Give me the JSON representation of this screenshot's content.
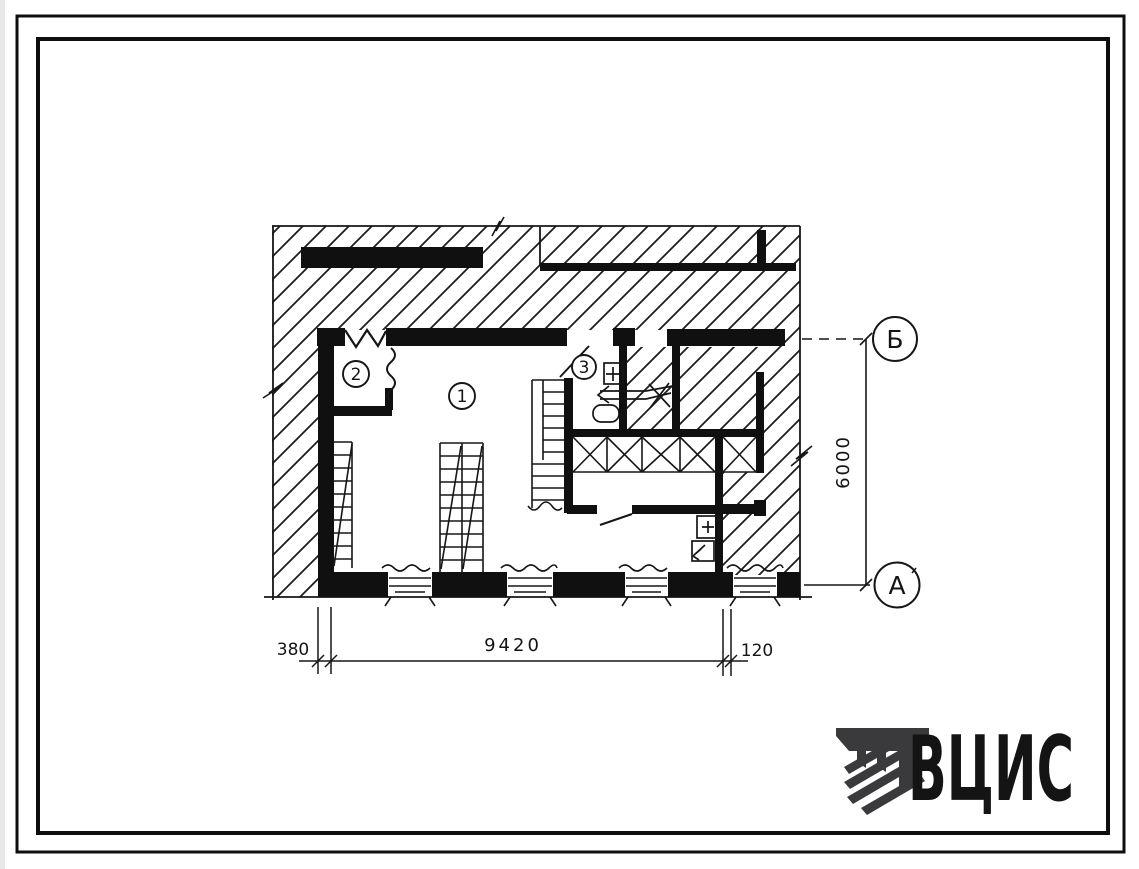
{
  "page": {
    "paper_color": "#ffffff",
    "ink_color": "#161616"
  },
  "plan": {
    "rooms": [
      {
        "number": "1"
      },
      {
        "number": "2"
      },
      {
        "number": "3"
      }
    ]
  },
  "axes": {
    "top": "Б",
    "bottom": "А"
  },
  "dimensions": {
    "bottom_left": "380",
    "bottom_span": "9420",
    "bottom_right": "120",
    "right_height": "6000"
  },
  "logo": {
    "text": "ВЦИС",
    "color": "#3a3a3c"
  }
}
